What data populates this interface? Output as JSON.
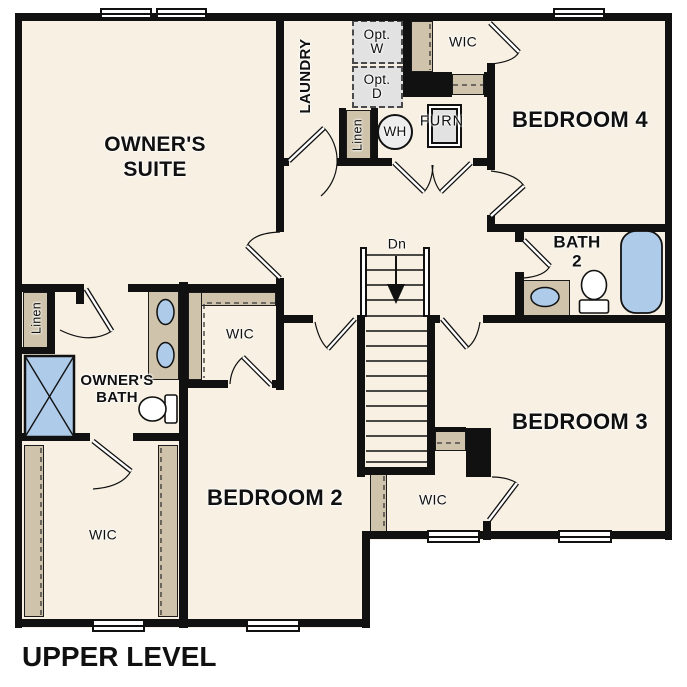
{
  "title": "UPPER LEVEL",
  "colors": {
    "floor": "#f7f0e3",
    "wall": "#111111",
    "closet": "#cfc3ab",
    "fixture_blue": "#aecbe9",
    "optional_gray": "#e2e2e2"
  },
  "rooms": {
    "owners_suite": {
      "line1": "OWNER'S",
      "line2": "SUITE"
    },
    "laundry": {
      "label": "LAUNDRY"
    },
    "bedroom4": {
      "label": "BEDROOM 4"
    },
    "bath2": {
      "line1": "BATH",
      "line2": "2"
    },
    "bedroom3": {
      "label": "BEDROOM 3"
    },
    "bedroom2": {
      "label": "BEDROOM 2"
    },
    "owners_bath": {
      "line1": "OWNER'S",
      "line2": "BATH"
    },
    "wic_bedroom4": {
      "label": "WIC"
    },
    "wic_bedroom2": {
      "label": "WIC"
    },
    "wic_bedroom3": {
      "label": "WIC"
    },
    "wic_owners": {
      "label": "WIC"
    },
    "linen_laundry": {
      "label": "Linen"
    },
    "linen_owners": {
      "label": "Linen"
    }
  },
  "fixtures": {
    "washer_optional": {
      "line1": "Opt.",
      "line2": "W"
    },
    "dryer_optional": {
      "line1": "Opt.",
      "line2": "D"
    },
    "water_heater": {
      "label": "WH"
    },
    "furnace": {
      "label": "FURN"
    },
    "stair_direction": {
      "label": "Dn"
    }
  }
}
